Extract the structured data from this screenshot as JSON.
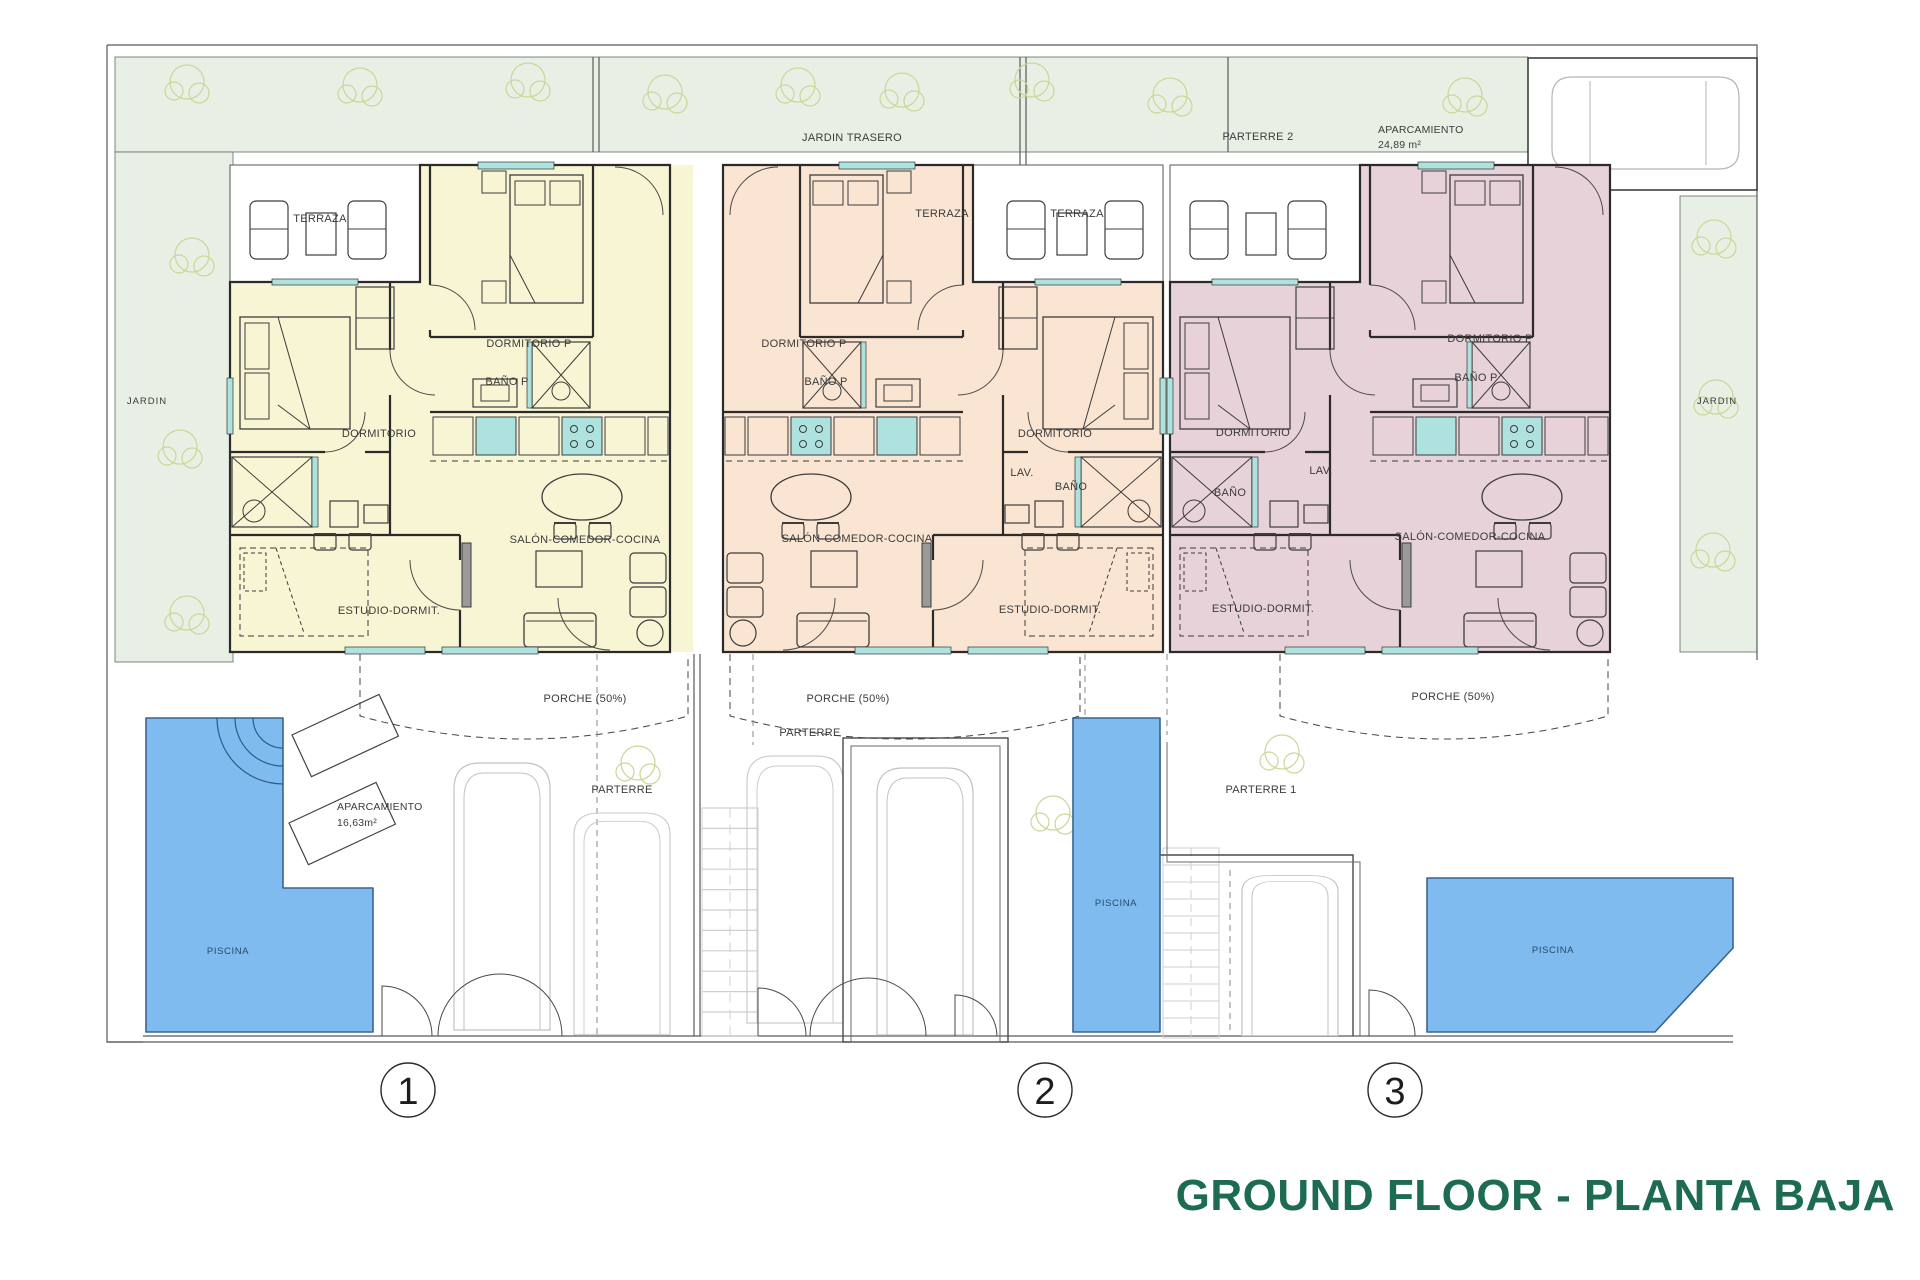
{
  "title": "GROUND FLOOR - PLANTA BAJA",
  "site": {
    "jardin_trasero": "JARDIN TRASERO",
    "parterre_2": "PARTERRE 2",
    "aparcamiento_top": {
      "label": "APARCAMIENTO",
      "area": "24,89 m²"
    },
    "jardin_left": "JARDIN",
    "jardin_right": "JARDIN",
    "aparcamiento_left": {
      "label": "APARCAMIENTO",
      "area": "16,63m²"
    },
    "parterre_a": "PARTERRE",
    "parterre_b": "PARTERRE",
    "parterre_1": "PARTERRE 1",
    "piscina_left": "PISCINA",
    "piscina_mid": "PISCINA",
    "piscina_right": "PISCINA"
  },
  "units": [
    {
      "number": "1",
      "terraza": "TERRAZA",
      "dormitorio_p": "DORMITORIO P",
      "bano_p": "BAÑO P",
      "dormitorio": "DORMITORIO",
      "salon": "SALÓN-COMEDOR-COCINA",
      "estudio": "ESTUDIO-DORMIT.",
      "porche": "PORCHE (50%)"
    },
    {
      "number": "2",
      "terraza": "TERRAZA",
      "dormitorio_p": "DORMITORIO P",
      "bano_p": "BAÑO P",
      "dormitorio": "DORMITORIO",
      "lav": "LAV.",
      "bano": "BAÑO",
      "salon": "SALÓN-COMEDOR-COCINA",
      "estudio": "ESTUDIO-DORMIT.",
      "porche": "PORCHE (50%)"
    },
    {
      "number": "3",
      "terraza": "TERRAZA",
      "dormitorio_p": "DORMITORIO P",
      "bano_p": "BAÑO P",
      "dormitorio": "DORMITORIO",
      "lav": "LAV.",
      "bano": "BAÑO",
      "salon": "SALÓN-COMEDOR-COCINA",
      "estudio": "ESTUDIO-DORMIT.",
      "porche": "PORCHE (50%)"
    }
  ],
  "colors": {
    "unit1": "#f8f5d4",
    "unit2": "#fae5d2",
    "unit3": "#e7d2d9",
    "garden": "#e8f0e5",
    "pool": "#7fbbee",
    "pool_border": "#39648f",
    "window": "#ade2de",
    "tree": "#c9d795",
    "title_green": "#1c6b52"
  }
}
